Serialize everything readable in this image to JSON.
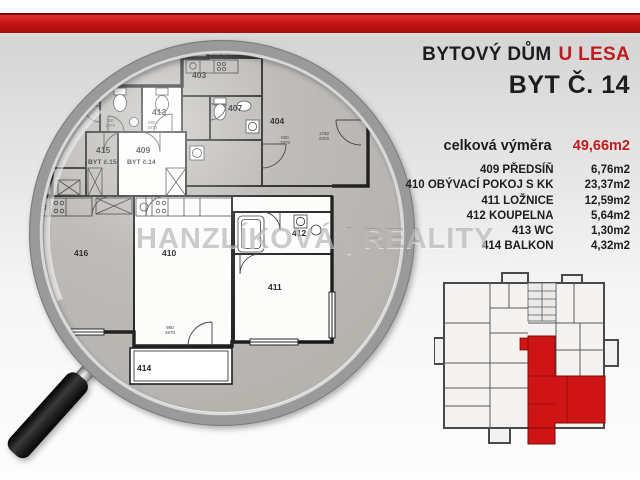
{
  "header": {
    "building_prefix": "BYTOVÝ DŮM",
    "building_accent": "U LESA",
    "unit_title": "BYT Č. 14"
  },
  "summary": {
    "label": "celková výměra",
    "value": "49,66m2"
  },
  "areas": {
    "rows": [
      {
        "name": "409 PŘEDSÍŇ",
        "value": "6,76m2"
      },
      {
        "name": "410 OBÝVACÍ POKOJ S KK",
        "value": "23,37m2"
      },
      {
        "name": "411 LOŽNICE",
        "value": "12,59m2"
      },
      {
        "name": "412 KOUPELNA",
        "value": "5,64m2"
      },
      {
        "name": "413 WC",
        "value": "1,30m2"
      },
      {
        "name": "414 BALKON",
        "value": "4,32m2"
      }
    ]
  },
  "watermark": {
    "text": "HANZLÍKOVÁ | REALITY"
  },
  "plan": {
    "units": {
      "byt13": "BYT č.13",
      "byt14": "BYT č.14",
      "byt15": "BYT č.15"
    },
    "rooms": {
      "r403": "403",
      "r404": "404",
      "r407": "407",
      "r409": "409",
      "r410": "410",
      "r411": "411",
      "r412": "412",
      "r413": "413",
      "r414": "414",
      "r415": "415",
      "r416": "416",
      "r419": "419"
    },
    "dims": {
      "dA": {
        "t": "800",
        "b": "1970"
      },
      "dB": {
        "t": "700",
        "b": "1970"
      },
      "dC": {
        "t": "800",
        "b": "1970"
      },
      "dD": {
        "t": "800",
        "b": "1970"
      },
      "dE": {
        "t": "1750",
        "b": "2300"
      },
      "dF": {
        "t": "900",
        "b": "1970"
      }
    }
  },
  "colors": {
    "top_bar_red": "#c41416",
    "accent_red": "#c01b1e",
    "highlight_red": "#ce1415",
    "plan_gray": "#b6b3af",
    "text_dark": "#1d1d1b"
  }
}
